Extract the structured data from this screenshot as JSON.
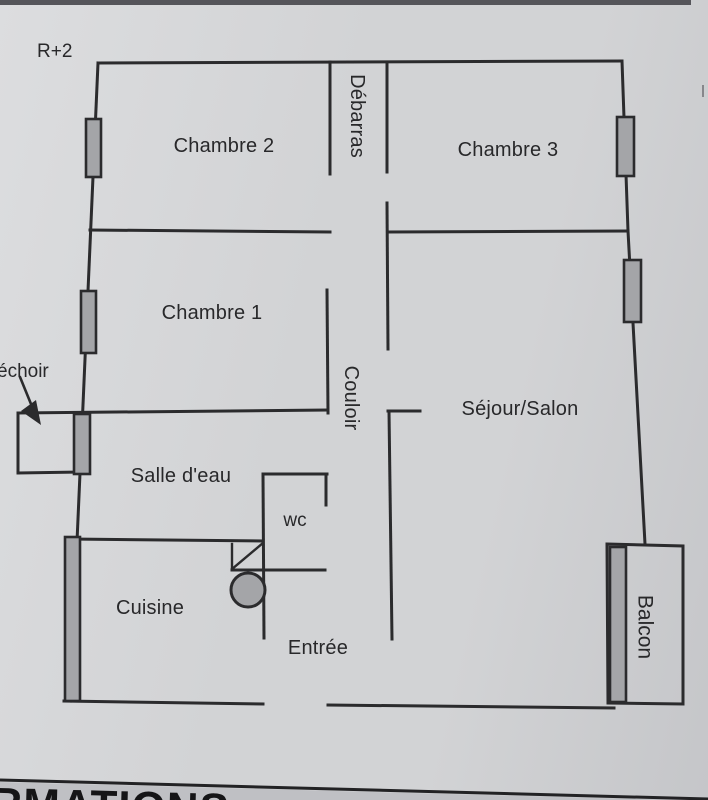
{
  "floor_label": "R+2",
  "rooms": {
    "chambre2": "Chambre 2",
    "debarras": "Débarras",
    "chambre3": "Chambre 3",
    "chambre1": "Chambre 1",
    "couloir": "Couloir",
    "sejour": "Séjour/Salon",
    "salle_eau": "Salle d'eau",
    "wc": "wc",
    "cuisine": "Cuisine",
    "entree": "Entrée",
    "balcon": "Balcon",
    "sechoir_partial": "échoir"
  },
  "footer": {
    "visible_text": "RMATIONS"
  },
  "colors": {
    "paper": "#d2d3d5",
    "paper-light": "#dcdddf",
    "paper-dark": "#c5c6c9",
    "line": "#2b2b2d",
    "window-fill": "#a4a5a8",
    "photo-edge": "#55555a",
    "footer-band": "#bfc0c4",
    "footer-text": "#151517"
  }
}
